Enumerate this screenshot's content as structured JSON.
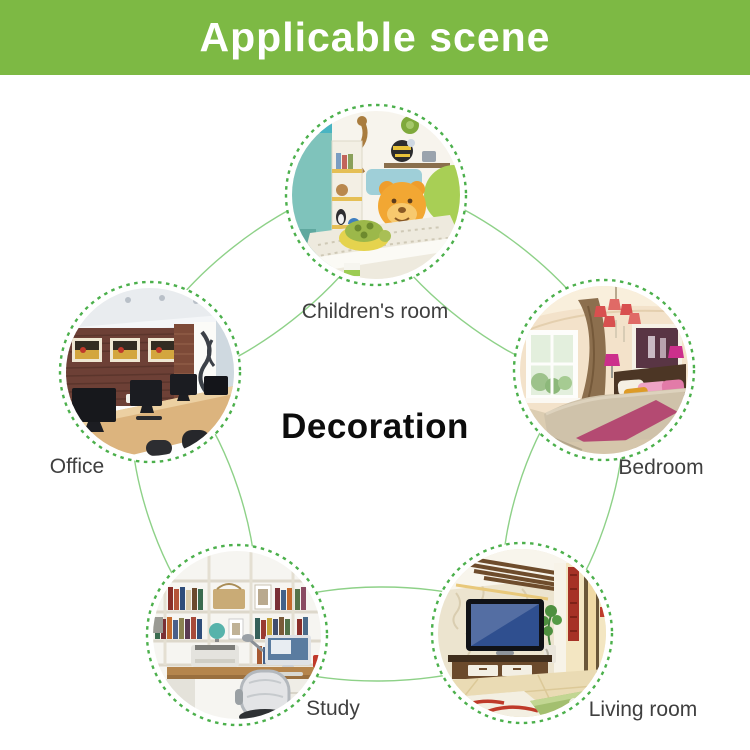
{
  "header": {
    "title": "Applicable scene",
    "background_color": "#7db944",
    "text_color": "#ffffff"
  },
  "diagram": {
    "center_label": "Decoration",
    "connector_color": "#8ed188",
    "ring_color": "#4cb04c",
    "nodes": [
      {
        "id": "children-room",
        "label": "Children's room"
      },
      {
        "id": "office",
        "label": "Office"
      },
      {
        "id": "bedroom",
        "label": "Bedroom"
      },
      {
        "id": "study",
        "label": "Study"
      },
      {
        "id": "living-room",
        "label": "Living room"
      }
    ]
  }
}
